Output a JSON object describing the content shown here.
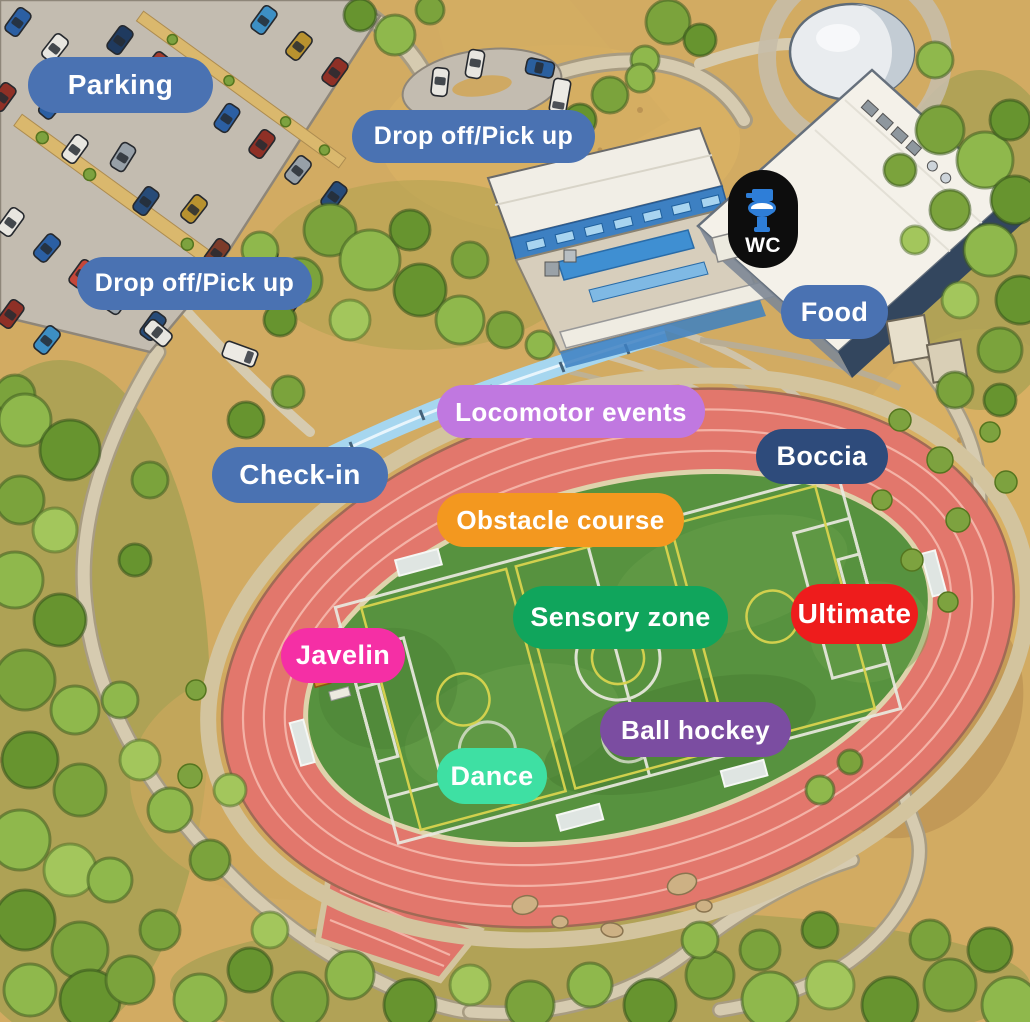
{
  "map_labels": {
    "parking": {
      "text": "Parking",
      "bg": "#4a72b2",
      "fg": "#ffffff"
    },
    "drop_off_top": {
      "text": "Drop off/Pick up",
      "bg": "#4a72b2",
      "fg": "#ffffff"
    },
    "drop_off_left": {
      "text": "Drop off/Pick up",
      "bg": "#4a72b2",
      "fg": "#ffffff"
    },
    "wc": {
      "text": "WC",
      "bg": "#0d0d0d",
      "fg": "#ffffff",
      "icon": "toilet-icon",
      "icon_color": "#2e7ed8"
    },
    "food": {
      "text": "Food",
      "bg": "#4a72b2",
      "fg": "#ffffff"
    },
    "locomotor_events": {
      "text": "Locomotor events",
      "bg": "#c078e0",
      "fg": "#ffffff"
    },
    "boccia": {
      "text": "Boccia",
      "bg": "#2e4b7b",
      "fg": "#ffffff"
    },
    "check_in": {
      "text": "Check-in",
      "bg": "#4a72b2",
      "fg": "#ffffff"
    },
    "obstacle_course": {
      "text": "Obstacle course",
      "bg": "#f3981f",
      "fg": "#ffffff"
    },
    "sensory_zone": {
      "text": "Sensory zone",
      "bg": "#10a55c",
      "fg": "#ffffff"
    },
    "ultimate": {
      "text": "Ultimate",
      "bg": "#ee1c1c",
      "fg": "#ffffff"
    },
    "javelin": {
      "text": "Javelin",
      "bg": "#f52fa5",
      "fg": "#ffffff"
    },
    "ball_hockey": {
      "text": "Ball hockey",
      "bg": "#7b4da1",
      "fg": "#ffffff"
    },
    "dance": {
      "text": "Dance",
      "bg": "#3ee0a3",
      "fg": "#ffffff"
    }
  }
}
